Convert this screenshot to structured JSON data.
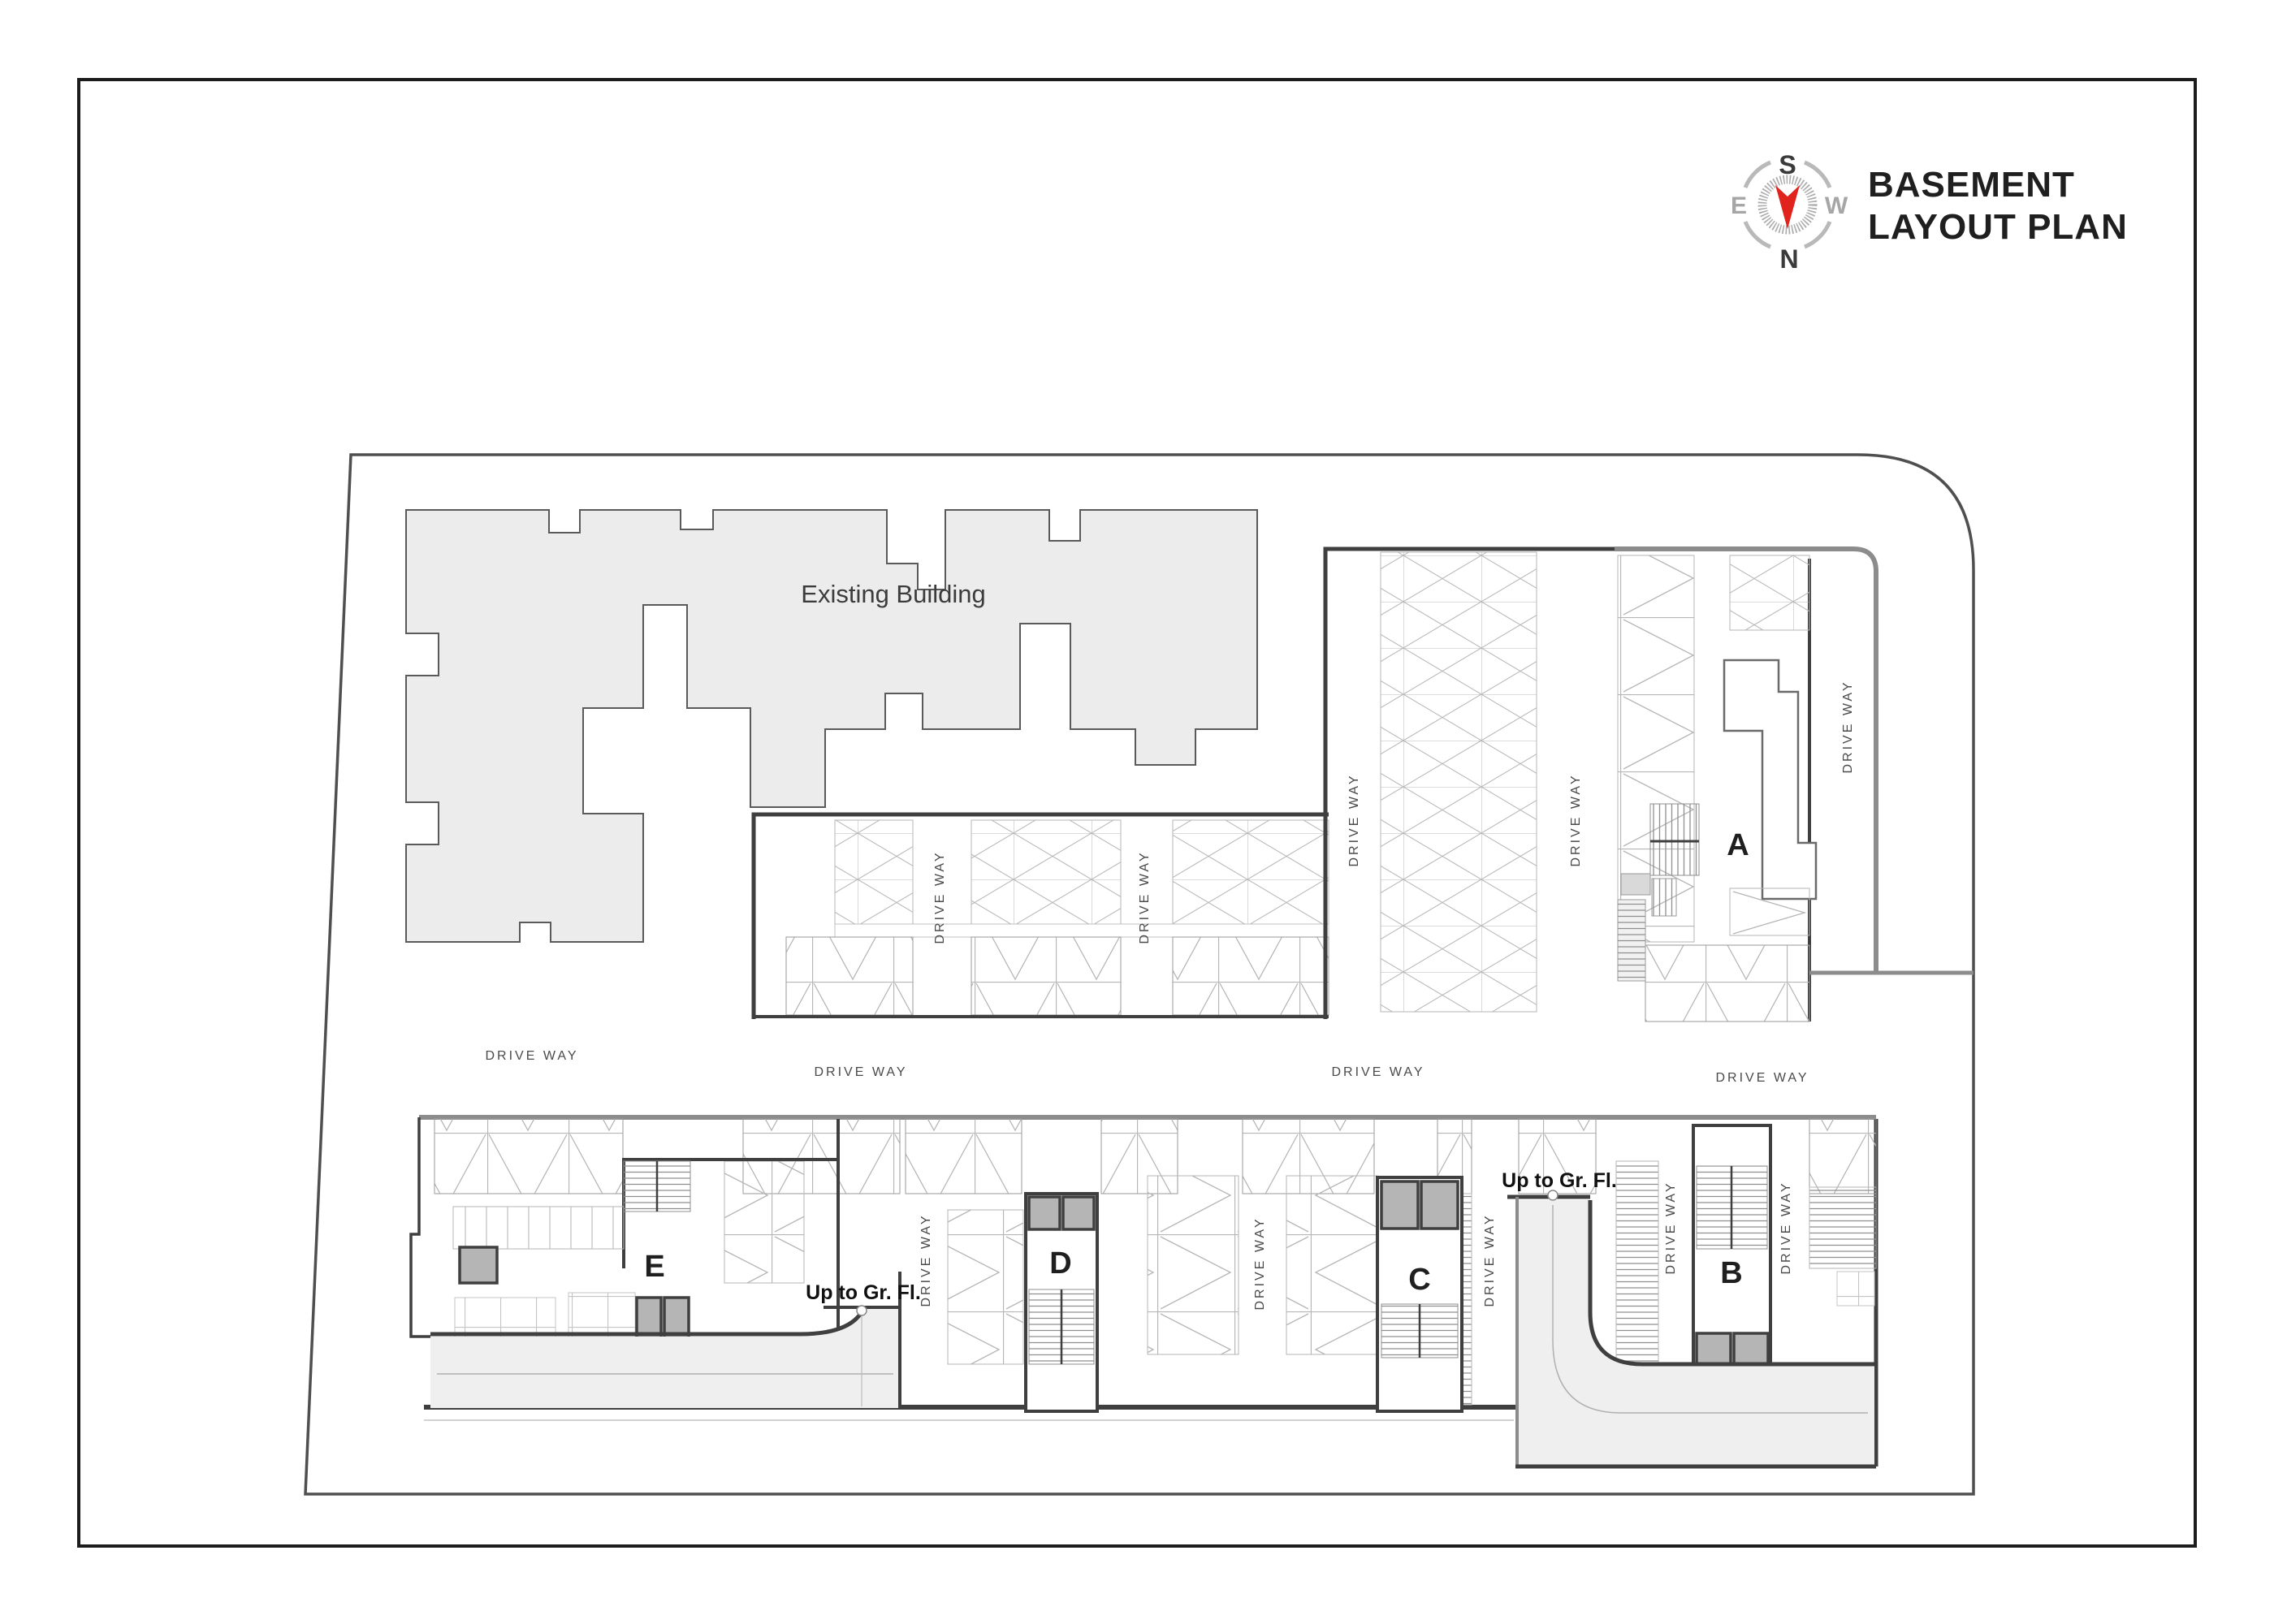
{
  "header": {
    "title_line1": "BASEMENT",
    "title_line2": "LAYOUT PLAN"
  },
  "compass": {
    "top": "S",
    "bottom": "N",
    "left": "E",
    "right": "W"
  },
  "plan": {
    "existing_building_label": "Existing Building",
    "drive_way_label": "DRIVE WAY",
    "up_to_ground_floor_label": "Up to Gr. Fl.",
    "cores": [
      {
        "label": "A"
      },
      {
        "label": "B"
      },
      {
        "label": "C"
      },
      {
        "label": "D"
      },
      {
        "label": "E"
      }
    ],
    "colors": {
      "wall_dark": "#3f3f3f",
      "wall_gray": "#8c8c8c",
      "boundary": "#4f4f4f",
      "building_fill": "#ececec",
      "ramp_fill": "#efefef",
      "lift_fill": "#b5b5b5",
      "stall_line": "#b6b6b6",
      "north_arrow_red": "#e0231c"
    }
  }
}
